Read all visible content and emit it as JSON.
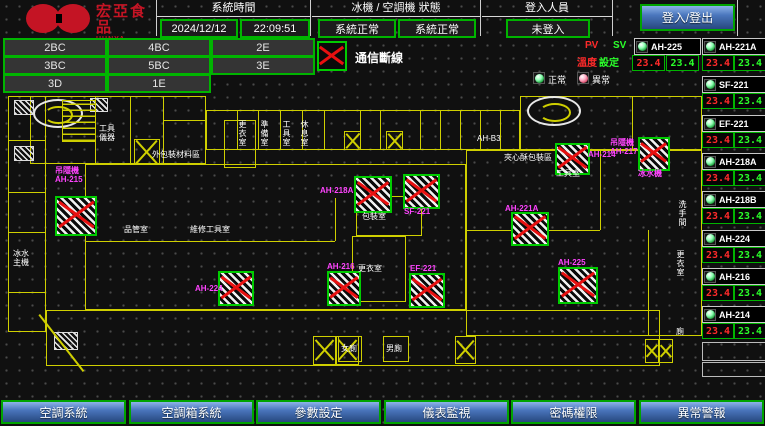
{
  "header": {
    "brand": {
      "name": "宏亞食品",
      "name_en": "HUNYA FOODS"
    },
    "system_time": {
      "label": "系統時間",
      "date": "2024/12/12",
      "time": "22:09:51"
    },
    "machine_status": {
      "label": "冰機 / 空調機 狀態",
      "chiller": "系統正常",
      "ahu": "系統正常"
    },
    "login": {
      "label": "登入人員",
      "status": "未登入",
      "button_label": "登入/登出"
    }
  },
  "floor_buttons": [
    "2BC",
    "4BC",
    "2E",
    "3BC",
    "5BC",
    "3E",
    "3D",
    "1E"
  ],
  "legend": {
    "comm_loss_label": "通信斷線",
    "pv_label": "PV",
    "sv_label": "SV",
    "temp_label": "溫度",
    "set_label": "設定",
    "normal_label": "正常",
    "abnormal_label": "異常"
  },
  "units_panel": {
    "primary": {
      "name": "AH-225",
      "pv": "23.4",
      "sv": "23.4"
    },
    "list": [
      {
        "name": "AH-221A",
        "pv": "23.4",
        "sv": "23.4"
      },
      {
        "name": "SF-221",
        "pv": "23.4",
        "sv": "23.4"
      },
      {
        "name": "EF-221",
        "pv": "23.4",
        "sv": "23.4"
      },
      {
        "name": "AH-218A",
        "pv": "23.4",
        "sv": "23.4"
      },
      {
        "name": "AH-218B",
        "pv": "23.4",
        "sv": "23.4"
      },
      {
        "name": "AH-224",
        "pv": "23.4",
        "sv": "23.4"
      },
      {
        "name": "AH-216",
        "pv": "23.4",
        "sv": "23.4"
      },
      {
        "name": "AH-214",
        "pv": "23.4",
        "sv": "23.4"
      }
    ],
    "empty_slots": 2
  },
  "floorplan": {
    "colors": {
      "wall": "#cfcf00",
      "equipment_label": "#ff44ff",
      "alarm_x": "#e81010"
    },
    "equipment": [
      {
        "lines": "吊隱機\nAH-215",
        "lx": 55,
        "ly": 166,
        "x": 55,
        "y": 196,
        "w": 38,
        "h": 36
      },
      {
        "lines": "AH-218A",
        "lx": 320,
        "ly": 186,
        "x": 354,
        "y": 176,
        "w": 34,
        "h": 33
      },
      {
        "lines": "SF-221",
        "lx": 404,
        "ly": 207,
        "x": 403,
        "y": 174,
        "w": 33,
        "h": 31
      },
      {
        "lines": "AH-214",
        "lx": 588,
        "ly": 150,
        "x": 555,
        "y": 143,
        "w": 31,
        "h": 28
      },
      {
        "lines": "吊隱機\nAH-217",
        "lx": 610,
        "ly": 138,
        "x": 638,
        "y": 137,
        "w": 28,
        "h": 30,
        "below": "冰水機"
      },
      {
        "lines": "AH-221A",
        "lx": 505,
        "ly": 204,
        "x": 511,
        "y": 212,
        "w": 34,
        "h": 30
      },
      {
        "lines": "AH-225",
        "lx": 558,
        "ly": 258,
        "x": 558,
        "y": 267,
        "w": 36,
        "h": 33
      },
      {
        "lines": "AH-224",
        "lx": 195,
        "ly": 284,
        "x": 218,
        "y": 271,
        "w": 32,
        "h": 31
      },
      {
        "lines": "AH-216",
        "lx": 327,
        "ly": 262,
        "x": 327,
        "y": 271,
        "w": 30,
        "h": 31
      },
      {
        "lines": "EF-221",
        "lx": 410,
        "ly": 264,
        "x": 409,
        "y": 273,
        "w": 32,
        "h": 31
      }
    ],
    "room_labels": [
      {
        "text": "工具\n儀器",
        "x": 99,
        "y": 124
      },
      {
        "text": "外包裝材料區",
        "x": 152,
        "y": 150
      },
      {
        "text": "更衣室",
        "x": 238,
        "y": 120,
        "v": true
      },
      {
        "text": "準備室",
        "x": 260,
        "y": 120,
        "v": true
      },
      {
        "text": "工具室",
        "x": 282,
        "y": 120,
        "v": true
      },
      {
        "text": "休息室",
        "x": 300,
        "y": 120,
        "v": true
      },
      {
        "text": "AH-B3",
        "x": 477,
        "y": 134
      },
      {
        "text": "夾心酥包裝區",
        "x": 504,
        "y": 153
      },
      {
        "text": "工具室",
        "x": 556,
        "y": 169
      },
      {
        "text": "包裝室",
        "x": 362,
        "y": 212
      },
      {
        "text": "更衣室",
        "x": 358,
        "y": 264
      },
      {
        "text": "品管室",
        "x": 124,
        "y": 225
      },
      {
        "text": "維修工具室",
        "x": 190,
        "y": 225
      },
      {
        "text": "冰水\n主機",
        "x": 13,
        "y": 249
      },
      {
        "text": "女廁",
        "x": 341,
        "y": 344
      },
      {
        "text": "男廁",
        "x": 386,
        "y": 344
      },
      {
        "text": "洗手間",
        "x": 678,
        "y": 200,
        "v": true
      },
      {
        "text": "更衣室",
        "x": 676,
        "y": 250,
        "v": true
      },
      {
        "text": "廁",
        "x": 676,
        "y": 327
      }
    ]
  },
  "menu": [
    "空調系統",
    "空調箱系統",
    "參數設定",
    "儀表監視",
    "密碼權限",
    "異常警報"
  ]
}
